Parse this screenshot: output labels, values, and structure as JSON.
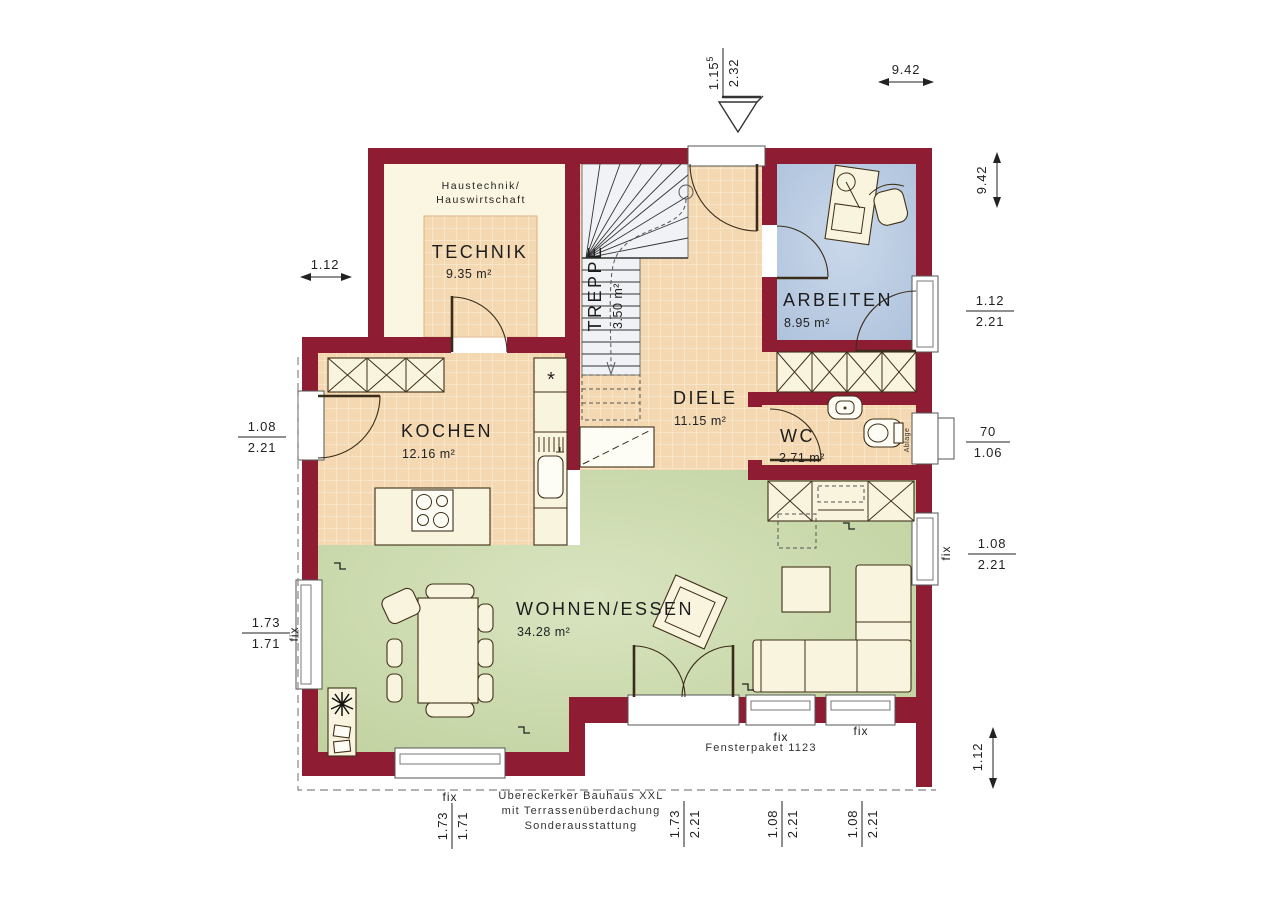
{
  "plan": {
    "rooms": {
      "technik": {
        "name": "TECHNIK",
        "area": "9.35 m²",
        "note1": "Haustechnik/",
        "note2": "Hauswirtschaft"
      },
      "treppe": {
        "name": "TREPPE",
        "area": "3.50 m²"
      },
      "diele": {
        "name": "DIELE",
        "area": "11.15 m²"
      },
      "arbeiten": {
        "name": "ARBEITEN",
        "area": "8.95 m²"
      },
      "kochen": {
        "name": "KOCHEN",
        "area": "12.16 m²"
      },
      "wc": {
        "name": "WC",
        "area": "2.71 m²"
      },
      "wohnen": {
        "name": "WOHNEN/ESSEN",
        "area": "34.28 m²"
      }
    },
    "dimensions": {
      "top_width": "9.42",
      "right_height": "9.42",
      "left_offset": "1.12",
      "right_bottom": "1.12",
      "entrance": {
        "w": "1.15",
        "sup": "5",
        "h": "2.32"
      },
      "right_arbeiten": {
        "w": "1.12",
        "h": "2.21"
      },
      "right_wc": {
        "w": "70",
        "h": "1.06"
      },
      "right_wohnen": {
        "w": "1.08",
        "h": "2.21",
        "fix": "fix"
      },
      "left_kochen": {
        "w": "1.08",
        "h": "2.21"
      },
      "left_bay": {
        "w": "1.73",
        "h": "1.71",
        "fix": "fix"
      },
      "bottom_bay": {
        "w": "1.73",
        "h": "1.71",
        "fix": "fix"
      },
      "bottom_door": {
        "w": "1.73",
        "h": "2.21"
      },
      "bottom_fix1": {
        "w": "1.08",
        "h": "2.21",
        "fix": "fix"
      },
      "bottom_fix2": {
        "w": "1.08",
        "h": "2.21",
        "fix": "fix"
      }
    },
    "labels": {
      "wc_shelf": "Ablage",
      "fensterpaket": "Fensterpaket 1123",
      "note_line1": "Übereckerker Bauhaus XXL",
      "note_line2": "mit Terrassenüberdachung",
      "note_line3": "Sonderausstattung",
      "kitchen_marker": "*"
    },
    "colors": {
      "wall": "#8E1D33",
      "tile": "#F3D8B1",
      "work_room": "#BCCDE4",
      "living": "#C8D7A9",
      "furniture": "#F8F4DE"
    }
  }
}
